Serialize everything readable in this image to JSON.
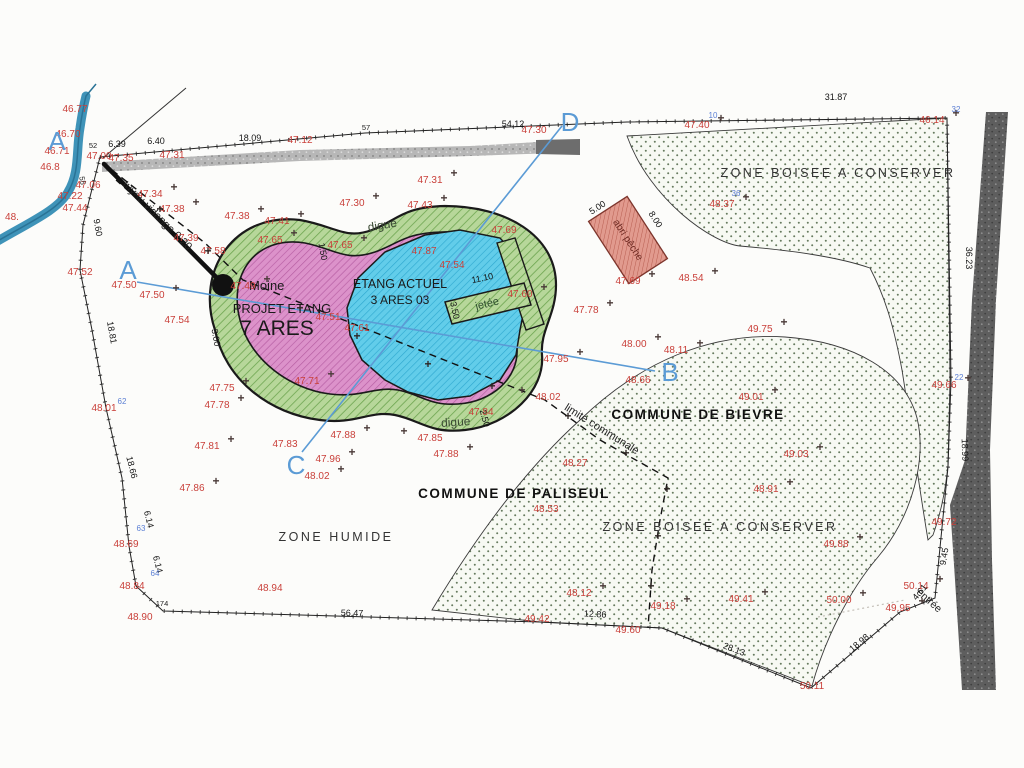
{
  "labels": {
    "zone_boisee_north": "ZONE BOISEE A CONSERVER",
    "zone_boisee_south": "ZONE BOISEE A CONSERVER",
    "zone_humide": "ZONE HUMIDE",
    "commune_bievre": "COMMUNE DE BIEVRE",
    "commune_paliseul": "COMMUNE DE PALISEUL",
    "dike_top": "digue",
    "dike_bottom": "digue",
    "jetty": "jetée",
    "moine": "Moine",
    "project_pond_line1": "PROJET ETANG",
    "project_pond_line2": "7 ARES",
    "current_pond_line1": "ETANG ACTUEL",
    "current_pond_line2": "3 ARES 03",
    "pipe": "tuyau vidange 0.20",
    "communal_boundary": "limite communale",
    "entrance": "entrée",
    "shelter": "abri pêche"
  },
  "colors": {
    "red_text": "#c9403a",
    "blue_section": "#5b9bd5",
    "dike_green": "#b7d79a",
    "project_pink": "#dc92ca",
    "pond_blue": "#62cdea",
    "stream_blue": "#3f93b8",
    "road_gray": "#606060"
  },
  "map": {
    "section_letters": [
      {
        "t": "A",
        "x": 57,
        "y": 150
      },
      {
        "t": "A",
        "x": 128,
        "y": 279
      },
      {
        "t": "B",
        "x": 670,
        "y": 381
      },
      {
        "t": "C",
        "x": 296,
        "y": 474
      },
      {
        "t": "D",
        "x": 570,
        "y": 131
      }
    ],
    "red_elevations": [
      {
        "v": "46.77",
        "x": 75,
        "y": 112
      },
      {
        "v": "46.70",
        "x": 68,
        "y": 137
      },
      {
        "v": "46.71",
        "x": 57,
        "y": 154
      },
      {
        "v": "46.8",
        "x": 50,
        "y": 170
      },
      {
        "v": "48.",
        "x": 12,
        "y": 220
      },
      {
        "v": "47.00",
        "x": 99,
        "y": 159
      },
      {
        "v": "47.35",
        "x": 121,
        "y": 161
      },
      {
        "v": "47.31",
        "x": 172,
        "y": 158
      },
      {
        "v": "47.12",
        "x": 300,
        "y": 143
      },
      {
        "v": "47.06",
        "x": 88,
        "y": 188
      },
      {
        "v": "47.22",
        "x": 70,
        "y": 199
      },
      {
        "v": "47.44",
        "x": 75,
        "y": 211
      },
      {
        "v": "47.34",
        "x": 150,
        "y": 197,
        "p": 1
      },
      {
        "v": "47.38",
        "x": 172,
        "y": 212,
        "p": 1
      },
      {
        "v": "47.39",
        "x": 186,
        "y": 241
      },
      {
        "v": "47.52",
        "x": 80,
        "y": 275
      },
      {
        "v": "47.50",
        "x": 124,
        "y": 288
      },
      {
        "v": "47.50",
        "x": 152,
        "y": 298,
        "p": 1
      },
      {
        "v": "47.54",
        "x": 177,
        "y": 323
      },
      {
        "v": "48.01",
        "x": 104,
        "y": 411
      },
      {
        "v": "47.75",
        "x": 222,
        "y": 391,
        "p": 1
      },
      {
        "v": "47.78",
        "x": 217,
        "y": 408,
        "p": 1
      },
      {
        "v": "47.81",
        "x": 207,
        "y": 449,
        "p": 1
      },
      {
        "v": "47.86",
        "x": 192,
        "y": 491,
        "p": 1
      },
      {
        "v": "48.69",
        "x": 126,
        "y": 547
      },
      {
        "v": "48.84",
        "x": 132,
        "y": 589
      },
      {
        "v": "48.90",
        "x": 140,
        "y": 620
      },
      {
        "v": "48.94",
        "x": 270,
        "y": 591
      },
      {
        "v": "47.38",
        "x": 237,
        "y": 219,
        "p": 1
      },
      {
        "v": "47.41",
        "x": 277,
        "y": 224,
        "p": 1
      },
      {
        "v": "47.30",
        "x": 352,
        "y": 206,
        "p": 1
      },
      {
        "v": "47.31",
        "x": 430,
        "y": 183,
        "p": 1
      },
      {
        "v": "47.43",
        "x": 420,
        "y": 208,
        "p": 1
      },
      {
        "v": "47.30",
        "x": 534,
        "y": 133
      },
      {
        "v": "47.65",
        "x": 270,
        "y": 243,
        "p": 1
      },
      {
        "v": "47.65",
        "x": 340,
        "y": 248,
        "p": 1
      },
      {
        "v": "47.58",
        "x": 213,
        "y": 254
      },
      {
        "v": "47.49",
        "x": 243,
        "y": 289,
        "p": 1
      },
      {
        "v": "47.87",
        "x": 424,
        "y": 254
      },
      {
        "v": "47.54",
        "x": 452,
        "y": 268
      },
      {
        "v": "47.51",
        "x": 328,
        "y": 320
      },
      {
        "v": "47.61",
        "x": 357,
        "y": 331
      },
      {
        "v": "47.71",
        "x": 307,
        "y": 384,
        "p": 1
      },
      {
        "v": "47.60",
        "x": 520,
        "y": 297,
        "p": 1
      },
      {
        "v": "47.69",
        "x": 504,
        "y": 233
      },
      {
        "v": "47.69",
        "x": 628,
        "y": 284,
        "p": 1
      },
      {
        "v": "48.54",
        "x": 691,
        "y": 281,
        "p": 1
      },
      {
        "v": "47.78",
        "x": 586,
        "y": 313,
        "p": 1
      },
      {
        "v": "49.75",
        "x": 760,
        "y": 332,
        "p": 1
      },
      {
        "v": "48.00",
        "x": 634,
        "y": 347,
        "p": 1
      },
      {
        "v": "48.11",
        "x": 676,
        "y": 353,
        "p": 1
      },
      {
        "v": "48.66",
        "x": 638,
        "y": 383
      },
      {
        "v": "47.95",
        "x": 556,
        "y": 362,
        "p": 1
      },
      {
        "v": "48.02",
        "x": 548,
        "y": 400,
        "p": 2
      },
      {
        "v": "48.02",
        "x": 317,
        "y": 479,
        "p": 1
      },
      {
        "v": "47.96",
        "x": 328,
        "y": 462,
        "p": 1
      },
      {
        "v": "47.88",
        "x": 343,
        "y": 438,
        "p": 1
      },
      {
        "v": "47.83",
        "x": 285,
        "y": 447
      },
      {
        "v": "47.85",
        "x": 430,
        "y": 441,
        "p": 2
      },
      {
        "v": "47.88",
        "x": 446,
        "y": 457,
        "p": 1
      },
      {
        "v": "47.84",
        "x": 481,
        "y": 415
      },
      {
        "v": "48.27",
        "x": 575,
        "y": 466
      },
      {
        "v": "48.53",
        "x": 546,
        "y": 512
      },
      {
        "v": "49.01",
        "x": 751,
        "y": 400,
        "p": 1
      },
      {
        "v": "49.03",
        "x": 796,
        "y": 457,
        "p": 1
      },
      {
        "v": "48.91",
        "x": 766,
        "y": 492,
        "p": 1
      },
      {
        "v": "49.88",
        "x": 836,
        "y": 547,
        "p": 1
      },
      {
        "v": "50.00",
        "x": 839,
        "y": 603,
        "p": 1
      },
      {
        "v": "48.12",
        "x": 579,
        "y": 596,
        "p": 1
      },
      {
        "v": "49.18",
        "x": 663,
        "y": 609,
        "p": 1
      },
      {
        "v": "49.41",
        "x": 741,
        "y": 602,
        "p": 1
      },
      {
        "v": "49.60",
        "x": 628,
        "y": 633
      },
      {
        "v": "49.42",
        "x": 537,
        "y": 622
      },
      {
        "v": "49.66",
        "x": 944,
        "y": 388,
        "p": 1
      },
      {
        "v": "49.72",
        "x": 944,
        "y": 525
      },
      {
        "v": "50.14",
        "x": 916,
        "y": 589,
        "p": 1
      },
      {
        "v": "49.95",
        "x": 898,
        "y": 611,
        "p": 1
      },
      {
        "v": "50.11",
        "x": 812,
        "y": 689
      },
      {
        "v": "47.40",
        "x": 697,
        "y": 128,
        "p": 1
      },
      {
        "v": "46.14",
        "x": 932,
        "y": 123,
        "p": 1
      },
      {
        "v": "48.37",
        "x": 722,
        "y": 207,
        "p": 1
      }
    ],
    "dimensions": [
      {
        "v": "6.39",
        "x": 117,
        "y": 147
      },
      {
        "v": "6.40",
        "x": 156,
        "y": 144
      },
      {
        "v": "18.09",
        "x": 250,
        "y": 141
      },
      {
        "v": "54.12",
        "x": 513,
        "y": 127
      },
      {
        "v": "31.87",
        "x": 836,
        "y": 100
      },
      {
        "v": "36.23",
        "x": 966,
        "y": 258,
        "r": 90
      },
      {
        "v": "18.99",
        "x": 962,
        "y": 450,
        "r": 88
      },
      {
        "v": "9.60",
        "x": 95,
        "y": 228,
        "r": 80
      },
      {
        "v": "18.81",
        "x": 109,
        "y": 333,
        "r": 80
      },
      {
        "v": "18.66",
        "x": 129,
        "y": 468,
        "r": 76
      },
      {
        "v": "6.14",
        "x": 146,
        "y": 520,
        "r": 76
      },
      {
        "v": "6.14",
        "x": 155,
        "y": 565,
        "r": 76
      },
      {
        "v": "56.47",
        "x": 352,
        "y": 616,
        "r": 1
      },
      {
        "v": "12.86",
        "x": 595,
        "y": 617,
        "r": 3
      },
      {
        "v": "28.13",
        "x": 733,
        "y": 652,
        "r": 21
      },
      {
        "v": "18.98",
        "x": 861,
        "y": 645,
        "r": -40
      },
      {
        "v": "9.45",
        "x": 947,
        "y": 557,
        "r": -80
      },
      {
        "v": "4.61",
        "x": 922,
        "y": 594,
        "r": -50
      },
      {
        "v": "11.10",
        "x": 483,
        "y": 281,
        "r": -12
      },
      {
        "v": "3.50",
        "x": 452,
        "y": 311,
        "r": 78
      },
      {
        "v": "3.00",
        "x": 213,
        "y": 338,
        "r": 80
      },
      {
        "v": "2.50",
        "x": 482,
        "y": 419,
        "r": 75
      },
      {
        "v": "1.50",
        "x": 320,
        "y": 252,
        "r": 80
      },
      {
        "v": "5.00",
        "x": 599,
        "y": 210,
        "r": -33
      },
      {
        "v": "8.00",
        "x": 653,
        "y": 221,
        "r": 57
      }
    ],
    "point_ids_blue": [
      {
        "v": "10",
        "x": 713,
        "y": 118
      },
      {
        "v": "32",
        "x": 956,
        "y": 112
      },
      {
        "v": "36",
        "x": 736,
        "y": 196
      },
      {
        "v": "22",
        "x": 959,
        "y": 380
      },
      {
        "v": "62",
        "x": 122,
        "y": 404
      },
      {
        "v": "63",
        "x": 141,
        "y": 531
      },
      {
        "v": "64",
        "x": 155,
        "y": 576
      }
    ],
    "point_ids_black": [
      {
        "v": "52",
        "x": 93,
        "y": 148
      },
      {
        "v": "55",
        "x": 80,
        "y": 181,
        "r": 80
      },
      {
        "v": "57",
        "x": 366,
        "y": 130
      },
      {
        "v": "174",
        "x": 162,
        "y": 606
      }
    ],
    "line_crosses": [
      {
        "t": "+",
        "x": 160,
        "y": 213
      },
      {
        "t": "+",
        "x": 208,
        "y": 255
      },
      {
        "t": "+",
        "x": 300,
        "y": 312
      },
      {
        "t": "+",
        "x": 357,
        "y": 340
      },
      {
        "t": "+",
        "x": 428,
        "y": 368
      },
      {
        "t": "+",
        "x": 492,
        "y": 390
      },
      {
        "t": "+",
        "x": 568,
        "y": 420
      },
      {
        "t": "+",
        "x": 626,
        "y": 457
      },
      {
        "t": "+",
        "x": 667,
        "y": 493
      },
      {
        "t": "+",
        "x": 658,
        "y": 540
      },
      {
        "t": "+",
        "x": 651,
        "y": 590
      }
    ]
  }
}
